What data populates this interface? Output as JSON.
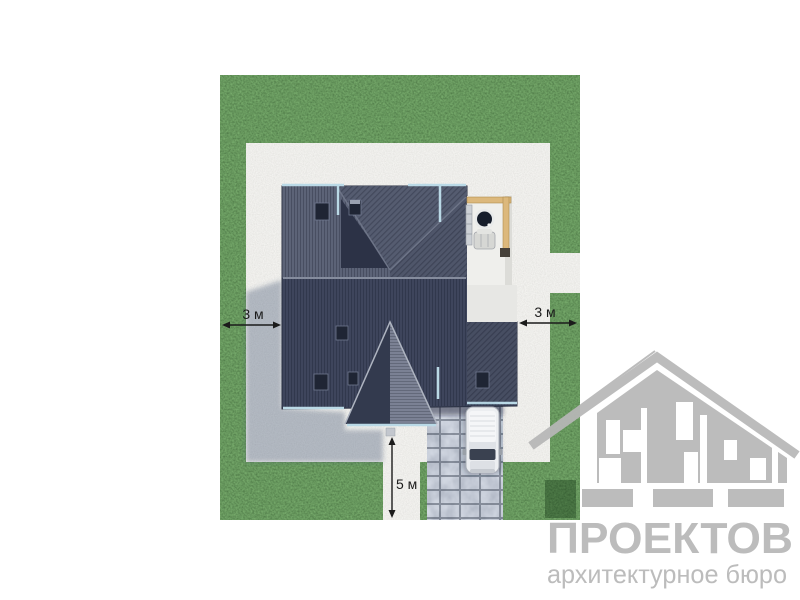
{
  "dimensions": {
    "left_setback": {
      "label": "3 м"
    },
    "right_setback": {
      "label": "3 м"
    },
    "front_setback": {
      "label": "5 м"
    }
  },
  "watermark": {
    "title": "ПРОЕКТОВ",
    "subtitle": "архитектурное бюро",
    "color": "#b7b7b7"
  },
  "colors": {
    "background": "#ffffff",
    "grass": "#336027",
    "concrete": "#d6d5d1",
    "driveway": "#929aa8",
    "roof_dark": "#3e455c",
    "roof_light": "#5c6377",
    "roof_mid": "#555c70",
    "roof_upper_right": "#4f566a",
    "roof_valley": "#2c3246",
    "roof_gable_light": "#7b8194",
    "roof_gable_dark": "#333a4e",
    "roof_wing": "#474e62",
    "eave": "#bad9e6",
    "wood": "#dcb87c",
    "patio": "#efefec",
    "terrace": "#e7e7e4",
    "car": "#eceef1",
    "dimension": "#1b1b1b"
  }
}
